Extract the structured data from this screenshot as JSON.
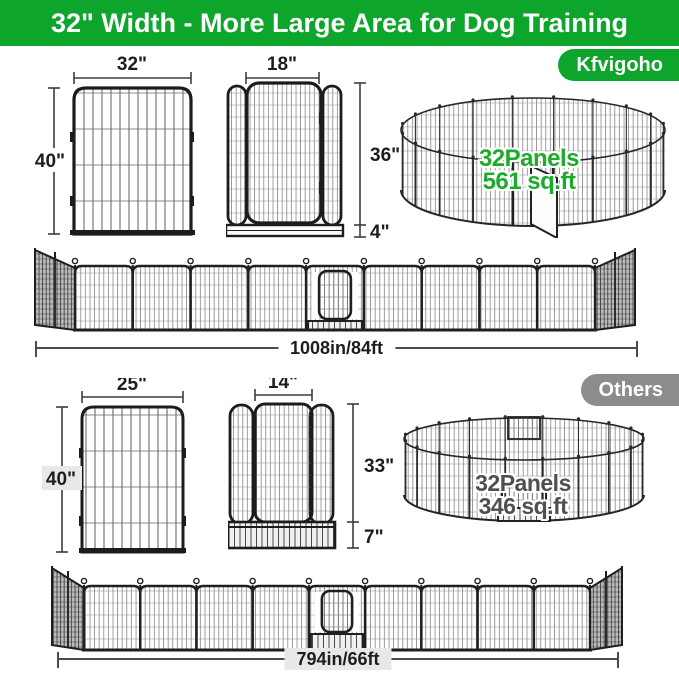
{
  "header": {
    "title": "32\" Width - More Large Area for Dog Training"
  },
  "sections": {
    "kfvigoho": {
      "badge": "Kfvigoho",
      "panel": {
        "width": "32\"",
        "height": "40\""
      },
      "gate": {
        "width": "18\"",
        "height": "36\"",
        "bottom": "4\""
      },
      "pen": {
        "panels": "32Panels",
        "area": "561 sq.ft"
      },
      "row": {
        "length": "1008in/84ft"
      }
    },
    "others": {
      "badge": "Others",
      "panel": {
        "width": "25\"",
        "height": "40\""
      },
      "gate": {
        "width": "14\"",
        "height": "33\"",
        "bottom": "7\""
      },
      "pen": {
        "panels": "32Panels",
        "area": "346 sq.ft"
      },
      "row": {
        "length": "794in/66ft"
      }
    }
  },
  "colors": {
    "header_green": "#0ea52c",
    "badge_green": "#0ea52c",
    "badge_gray": "#8c8c8c",
    "pen_text_green": "#1cab2c",
    "pen_text_gray": "#4f4f4f",
    "section_gray_bg": "#e8e8e8",
    "line_dark": "#1d1d1d"
  }
}
